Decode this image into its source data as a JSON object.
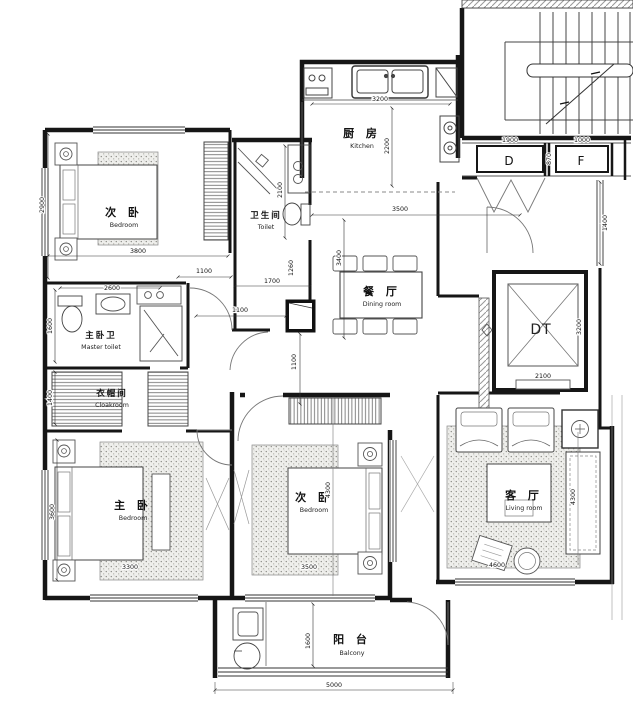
{
  "page": {
    "title": "Apartment floor plan"
  },
  "floor_plan": {
    "rooms": {
      "bedroom_top": {
        "zh": "次 卧",
        "en": "Bedroom"
      },
      "kitchen": {
        "zh": "厨 房",
        "en": "Kitchen"
      },
      "toilet": {
        "zh": "卫生间",
        "en": "Toilet"
      },
      "dining": {
        "zh": "餐 厅",
        "en": "Dining room"
      },
      "master_toilet": {
        "zh": "主卧卫",
        "en": "Master toilet"
      },
      "cloakroom": {
        "zh": "衣帽间",
        "en": "Cloakroom"
      },
      "master_bedroom": {
        "zh": "主 卧",
        "en": "Bedroom"
      },
      "bedroom_mid": {
        "zh": "次 卧",
        "en": "Bedroom"
      },
      "living": {
        "zh": "客 厅",
        "en": "Living room"
      },
      "balcony": {
        "zh": "阳 台",
        "en": "Balcony"
      },
      "elevator": {
        "label": "DT"
      }
    },
    "doors": {
      "d": "D",
      "f": "F"
    },
    "dimensions": {
      "bedroom_top_h": "2900",
      "bedroom_top_w": "3800",
      "corridor_a": "1100",
      "toilet_w": "1700",
      "toilet_s": "1260",
      "toilet_h": "2100",
      "hall_a": "1100",
      "hall_b": "1100",
      "master_toilet_w": "2600",
      "master_toilet_h": "1600",
      "cloakroom_h": "1400",
      "master_bedroom_h": "3600",
      "master_bedroom_w": "3300",
      "kitchen_w": "3200",
      "kitchen_h": "2200",
      "dining_w": "3500",
      "dining_h": "3400",
      "bedroom_mid_h": "4300",
      "bedroom_mid_w": "3500",
      "elevator_w": "2100",
      "elevator_h": "3200",
      "door_d_w": "1900",
      "door_f_w": "1000",
      "door_gap": "870",
      "right_side": "1400",
      "living_h": "4300",
      "living_w": "4600",
      "balcony_h": "1600",
      "balcony_w": "5000"
    }
  }
}
